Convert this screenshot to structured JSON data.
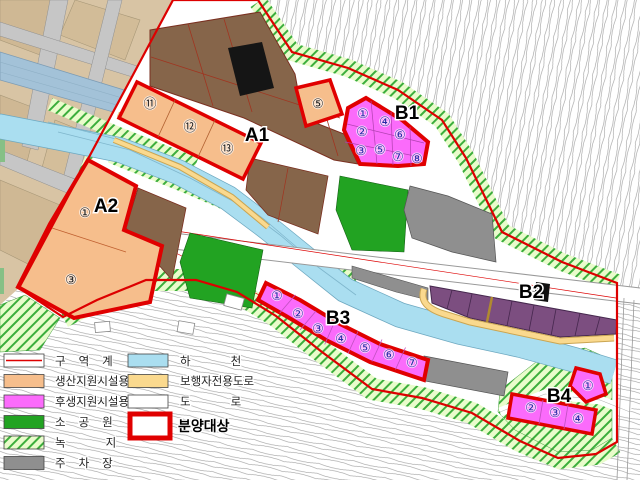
{
  "map": {
    "zone_labels": [
      "A1",
      "A2",
      "B1",
      "B2",
      "B3",
      "B4"
    ],
    "parcels": {
      "a1_strip": [
        "⑪",
        "⑫",
        "⑬"
      ],
      "a1_east": "⑤",
      "a2": [
        "①",
        "③"
      ],
      "b1": [
        "①",
        "②",
        "③",
        "④",
        "⑤",
        "⑥",
        "⑦",
        "⑧"
      ],
      "b3": [
        "①",
        "②",
        "③",
        "④",
        "⑤",
        "⑥",
        "⑦"
      ],
      "b4": [
        "①",
        "②",
        "③",
        "④"
      ]
    }
  },
  "legend": {
    "left": [
      {
        "label": "구역계",
        "swatch": "district-boundary"
      },
      {
        "label": "생산지원시설용지",
        "swatch": "production-support"
      },
      {
        "label": "후생지원시설용지",
        "swatch": "welfare-support"
      },
      {
        "label": "소공원",
        "swatch": "small-park"
      },
      {
        "label": "녹지",
        "swatch": "green-belt"
      },
      {
        "label": "주차장",
        "swatch": "parking"
      }
    ],
    "right": [
      {
        "label": "하천",
        "swatch": "river"
      },
      {
        "label": "보행자전용도로",
        "swatch": "pedestrian-road"
      },
      {
        "label": "도로",
        "swatch": "road"
      },
      {
        "label": "분양대상",
        "swatch": "sale-target"
      }
    ]
  },
  "colors": {
    "boundary_red": "#dd0000",
    "sale_red": "#e00000",
    "production_orange": "#f6be8c",
    "welfare_magenta": "#fb6bfb",
    "industrial_brown": "#86654a",
    "b2_purple": "#7c4e80",
    "park_green": "#22a322",
    "river_cyan": "#aadef0",
    "pedestrian_yellow": "#fad98e",
    "parking_gray": "#8f8f8f"
  }
}
